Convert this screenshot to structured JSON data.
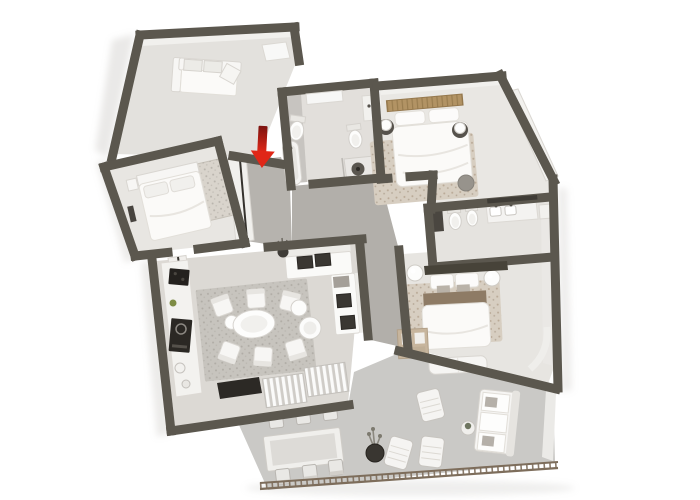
{
  "meta": {
    "title": "3D rendered apartment floor plan, top-down cutaway view",
    "canvas_width": 700,
    "canvas_height": 500,
    "background": "#ffffff",
    "visible_text": "none"
  },
  "colors": {
    "wall": "#5b574e",
    "entrance_arrow": "#e02718",
    "entrance_arrow_dark": "#7c130f",
    "railing": "#7d6d5b",
    "wood": "#b29364",
    "rug_beige": "#d7cec1",
    "rug_gray": "#c7c4be",
    "dark_fixture": "#34312d",
    "white_furniture": "#f7f6f4"
  },
  "entrance_marker": {
    "type": "arrow",
    "direction": "down",
    "meaning": "apartment entrance"
  },
  "rooms": [
    {
      "id": "lounge",
      "floor_color": "#e3e1dd",
      "furniture": [
        "sofa"
      ]
    },
    {
      "id": "entry-hall",
      "floor_color": "#b6b3ae",
      "furniture": [
        "closet",
        "entrance-door"
      ]
    },
    {
      "id": "hallway",
      "floor_color": "#b2afaa",
      "furniture": [
        "plant"
      ]
    },
    {
      "id": "small-bedroom",
      "floor_color": "#e8e6e2",
      "furniture": [
        "single-bed",
        "nightstand",
        "art-panel",
        "door"
      ]
    },
    {
      "id": "main-bathroom",
      "floor_color": "#e2dfdb",
      "furniture": [
        "skylight",
        "toilet",
        "bidet",
        "bathtub",
        "shower",
        "vanity"
      ]
    },
    {
      "id": "bedroom-1",
      "floor_color": "#e9e7e3",
      "furniture": [
        "double-bed",
        "wood-headboard",
        "pillows",
        "bedside-lamps",
        "rug",
        "wardrobe",
        "pouf"
      ]
    },
    {
      "id": "ensuite-bathroom",
      "floor_color": "#e5e3df",
      "furniture": [
        "cabinet",
        "toilet",
        "bidet",
        "double-vanity",
        "mirror",
        "shelf"
      ]
    },
    {
      "id": "bedroom-2",
      "floor_color": "#e7e5e1",
      "furniture": [
        "double-bed",
        "dark-headboard",
        "ball-lamps",
        "blanket",
        "rug",
        "wardrobe",
        "bench"
      ]
    },
    {
      "id": "living-room",
      "floor_color": "#dcd9d4",
      "furniture": [
        "kitchen-counter",
        "cooktop",
        "oven",
        "corner-sofa",
        "dark-cushions",
        "coffee-tables",
        "dining-table",
        "dining-chairs",
        "area-rug",
        "doormat",
        "louver-doors"
      ]
    },
    {
      "id": "balcony",
      "floor_color": "#cac9c6",
      "furniture": [
        "outdoor-dining-table",
        "outdoor-chairs",
        "lounge-chairs",
        "side-table",
        "planter",
        "outdoor-sofa",
        "railing"
      ]
    }
  ]
}
